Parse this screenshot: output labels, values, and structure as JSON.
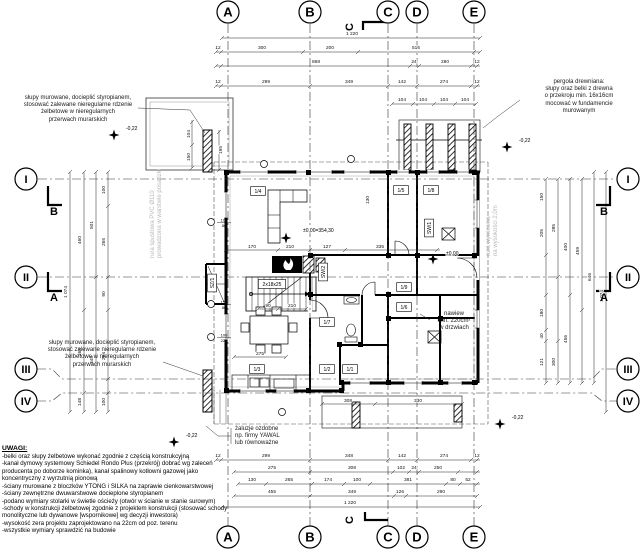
{
  "drawing": {
    "axes_top": [
      {
        "l": "A",
        "x": 228
      },
      {
        "l": "B",
        "x": 310
      },
      {
        "l": "C",
        "x": 388
      },
      {
        "l": "D",
        "x": 417
      },
      {
        "l": "E",
        "x": 474
      }
    ],
    "axes_bottom": [
      {
        "l": "A",
        "x": 228
      },
      {
        "l": "B",
        "x": 310
      },
      {
        "l": "C",
        "x": 388
      },
      {
        "l": "D",
        "x": 417
      },
      {
        "l": "E",
        "x": 474
      }
    ],
    "axes_left": [
      {
        "l": "I",
        "y": 179,
        "line": 179
      },
      {
        "l": "II",
        "y": 277,
        "line": 277
      },
      {
        "l": "III",
        "y": 369,
        "line": 379
      },
      {
        "l": "IV",
        "y": 401,
        "line": 393
      }
    ],
    "axes_right": [
      {
        "l": "I",
        "y": 179,
        "line": 179
      },
      {
        "l": "II",
        "y": 277,
        "line": 277
      },
      {
        "l": "III",
        "y": 369,
        "line": 379
      },
      {
        "l": "IV",
        "y": 401,
        "line": 393
      }
    ],
    "sections": [
      {
        "l": "B",
        "x": 54,
        "y": 215
      },
      {
        "l": "A",
        "x": 54,
        "y": 301
      },
      {
        "l": "B",
        "x": 604,
        "y": 215
      },
      {
        "l": "A",
        "x": 604,
        "y": 301
      },
      {
        "l": "C",
        "x": 353,
        "y": 27,
        "rot": 1
      },
      {
        "l": "C",
        "x": 353,
        "y": 520,
        "rot": 1
      }
    ],
    "rooms": [
      {
        "t": "1/4",
        "x": 258,
        "y": 191
      },
      {
        "t": "1/5",
        "x": 401,
        "y": 190
      },
      {
        "t": "1/8",
        "x": 431,
        "y": 190
      },
      {
        "t": "SW/1",
        "x": 429,
        "y": 228,
        "v": 1
      },
      {
        "t": "SW/2",
        "x": 323,
        "y": 272,
        "v": 1
      },
      {
        "t": "SZ/1",
        "x": 212,
        "y": 283,
        "v": 1
      },
      {
        "t": "1/7",
        "x": 327,
        "y": 322
      },
      {
        "t": "1/3",
        "x": 257,
        "y": 369
      },
      {
        "t": "1/2",
        "x": 327,
        "y": 369
      },
      {
        "t": "1/1",
        "x": 350,
        "y": 369
      },
      {
        "t": "1/9",
        "x": 404,
        "y": 287
      },
      {
        "t": "1/6",
        "x": 404,
        "y": 307
      },
      {
        "t": "2x18x25",
        "x": 272,
        "y": 284
      }
    ],
    "dims": [
      [
        "1 220",
        352,
        35
      ],
      [
        "12",
        218,
        49
      ],
      [
        "300",
        262,
        49
      ],
      [
        "200",
        330,
        49
      ],
      [
        "516",
        416,
        49
      ],
      [
        "868",
        316,
        63
      ],
      [
        "24",
        414,
        63
      ],
      [
        "280",
        445,
        63
      ],
      [
        "12",
        477,
        63
      ],
      [
        "12",
        218,
        83
      ],
      [
        "299",
        266,
        83
      ],
      [
        "349",
        349,
        83
      ],
      [
        "142",
        402,
        83
      ],
      [
        "274",
        444,
        83
      ],
      [
        "12",
        477,
        83
      ],
      [
        "104",
        402,
        101
      ],
      [
        "104",
        423,
        101
      ],
      [
        "104",
        444,
        101
      ],
      [
        "104",
        465,
        101
      ],
      [
        "12",
        218,
        457
      ],
      [
        "299",
        266,
        457
      ],
      [
        "348",
        349,
        457
      ],
      [
        "142",
        402,
        457
      ],
      [
        "274",
        444,
        457
      ],
      [
        "12",
        477,
        457
      ],
      [
        "275",
        272,
        469
      ],
      [
        "308",
        352,
        469
      ],
      [
        "102",
        401,
        469
      ],
      [
        "24",
        414,
        469
      ],
      [
        "250",
        438,
        469
      ],
      [
        "130",
        252,
        481
      ],
      [
        "265",
        289,
        481
      ],
      [
        "174",
        328,
        481
      ],
      [
        "100",
        357,
        481
      ],
      [
        "381",
        408,
        481
      ],
      [
        "80",
        453,
        481
      ],
      [
        "52",
        468,
        481
      ],
      [
        "455",
        272,
        493
      ],
      [
        "349",
        352,
        493
      ],
      [
        "126",
        400,
        493
      ],
      [
        "290",
        441,
        493
      ],
      [
        "1 220",
        350,
        504
      ],
      [
        "100",
        105,
        190,
        -90
      ],
      [
        "265",
        105,
        242,
        -90
      ],
      [
        "90",
        105,
        294,
        -90
      ],
      [
        "264",
        105,
        356,
        -90
      ],
      [
        "100",
        105,
        402,
        -90
      ],
      [
        "501",
        93,
        225,
        -90
      ],
      [
        "345",
        93,
        360,
        -90
      ],
      [
        "460",
        81,
        240,
        -90
      ],
      [
        "264",
        81,
        352,
        -90
      ],
      [
        "148",
        81,
        402,
        -90
      ],
      [
        "1 074",
        67,
        292,
        -90
      ],
      [
        "150",
        543,
        197,
        -90
      ],
      [
        "205",
        543,
        233,
        -90
      ],
      [
        "180",
        543,
        313,
        -90
      ],
      [
        "40",
        543,
        336,
        -90
      ],
      [
        "121",
        543,
        362,
        -90
      ],
      [
        "285",
        555,
        228,
        -90
      ],
      [
        "300",
        555,
        362,
        -90
      ],
      [
        "400",
        567,
        247,
        -90
      ],
      [
        "456",
        567,
        339,
        -90
      ],
      [
        "459",
        579,
        251,
        -90
      ],
      [
        "646",
        591,
        277,
        -90
      ],
      [
        "1 074",
        603,
        296,
        -90
      ],
      [
        "170",
        252,
        248
      ],
      [
        "210",
        290,
        248
      ],
      [
        "127",
        327,
        248
      ],
      [
        "335",
        380,
        248
      ],
      [
        "90",
        268,
        307
      ],
      [
        "210",
        292,
        307
      ],
      [
        "275",
        260,
        355
      ],
      [
        "130",
        369,
        200,
        -90
      ],
      [
        "104",
        190,
        134,
        -90
      ],
      [
        "150",
        190,
        157,
        -90
      ],
      [
        "195",
        222,
        150,
        -90
      ],
      [
        "308",
        348,
        402
      ],
      [
        "330",
        418,
        402
      ]
    ],
    "levels": [
      {
        "t": "±0,00=354,30",
        "tx": 303,
        "ty": 232,
        "sx": 286,
        "sy": 238
      },
      {
        "t": "±0,00",
        "tx": 446,
        "ty": 255,
        "sx": 433,
        "sy": 259
      },
      {
        "t": "-0,22",
        "tx": 126,
        "ty": 130,
        "sx": 114,
        "sy": 135
      },
      {
        "t": "-0,22",
        "tx": 519,
        "ty": 142,
        "sx": 507,
        "sy": 147
      },
      {
        "t": "-0,22",
        "tx": 186,
        "ty": 437,
        "sx": 174,
        "sy": 442
      },
      {
        "t": "-0,22",
        "tx": 512,
        "ty": 419,
        "sx": 500,
        "sy": 424
      }
    ],
    "markers": [
      {
        "x": 264,
        "y": 164
      },
      {
        "x": 351,
        "y": 159
      },
      {
        "x": 211,
        "y": 222,
        "a": "100",
        "b": "80"
      },
      {
        "x": 211,
        "y": 304,
        "a": "150",
        "b": "80"
      },
      {
        "x": 211,
        "y": 337,
        "a": "100",
        "b": "225"
      },
      {
        "x": 282,
        "y": 412
      }
    ],
    "annotations": {
      "pillars_top": {
        "x": 16,
        "y": 95,
        "w": 124,
        "cls": "center",
        "lines": [
          "słupy murowane, docieplić styropianem,",
          "stosować zalewane nieregularne rdzenie",
          "żelbetowe w nieregularnych",
          "przerwach murarskich"
        ]
      },
      "pillars_bottom": {
        "x": 38,
        "y": 340,
        "w": 128,
        "cls": "center",
        "lines": [
          "słupy murowane, docieplić styropianem,",
          "stosować zalewane nieregularne rdzenie",
          "żelbetowe w nieregularnych",
          "przerwach murarskich"
        ]
      },
      "pergola": {
        "x": 520,
        "y": 79,
        "w": 118,
        "cls": "center",
        "lines": [
          "pergola drewniana:",
          "słupy oraz belki z drewna",
          "o przekroju min. 16x16cm",
          "mocować w fundamencie",
          "murowanym"
        ]
      },
      "blinds": {
        "x": 235,
        "y": 426,
        "w": 64,
        "cls": "",
        "lines": [
          "żaluzje ozdobne",
          "np. firmy YAWAL",
          "lub równoważne"
        ]
      },
      "vent": {
        "x": 430,
        "y": 311,
        "w": 48,
        "cls": "center",
        "lines": [
          "nawiew",
          "min. 220cm²",
          "w drzwiach"
        ]
      },
      "pipe_left": {
        "x": 150,
        "y": 258,
        "w": 112,
        "cls": "gray rot",
        "lines": [
          "rura spustowa PVC Ø110",
          "prowadzona w warstwie posadzki"
        ]
      },
      "pipe_right": {
        "x": 486,
        "y": 256,
        "w": 96,
        "cls": "gray rot",
        "lines": [
          "rura wywiewna",
          "na wysokości 2,0m"
        ]
      }
    },
    "notes": {
      "title": "UWAGI:",
      "items": [
        "-belki oraz słupy żelbetowe wykonać zgodnie z częścią konstrukcyjną",
        "-kanał dymowy systemowy Schiedel Rondo Plus (przekrój) dobrać wg zaleceń producenta po doborze kominka), kanał spalinowy kotłowni gazowej jako koncentryczny z wyrzutnią pionową",
        "-ściany murowane z bloczków YTONG i SILKA na zaprawie cienkowarstwowej",
        "-ściany zewnętrzne dwuwarstwowe docieplone styropianem",
        "-podano wymiary stolarki w świetle ościeży (otwór w ścianie w stanie surowym)",
        "-schody w konstrukcji żelbetowej zgodnie z projektem konstrukcji (stosować schody monolityczne lub dywanowe [wspornikowe] wg decyzji inwestora)",
        "-wysokość zera projektu zaprojektowano na 22cm od poz. terenu",
        "-wszystkie wymiary sprawdzić na budowie"
      ]
    }
  }
}
